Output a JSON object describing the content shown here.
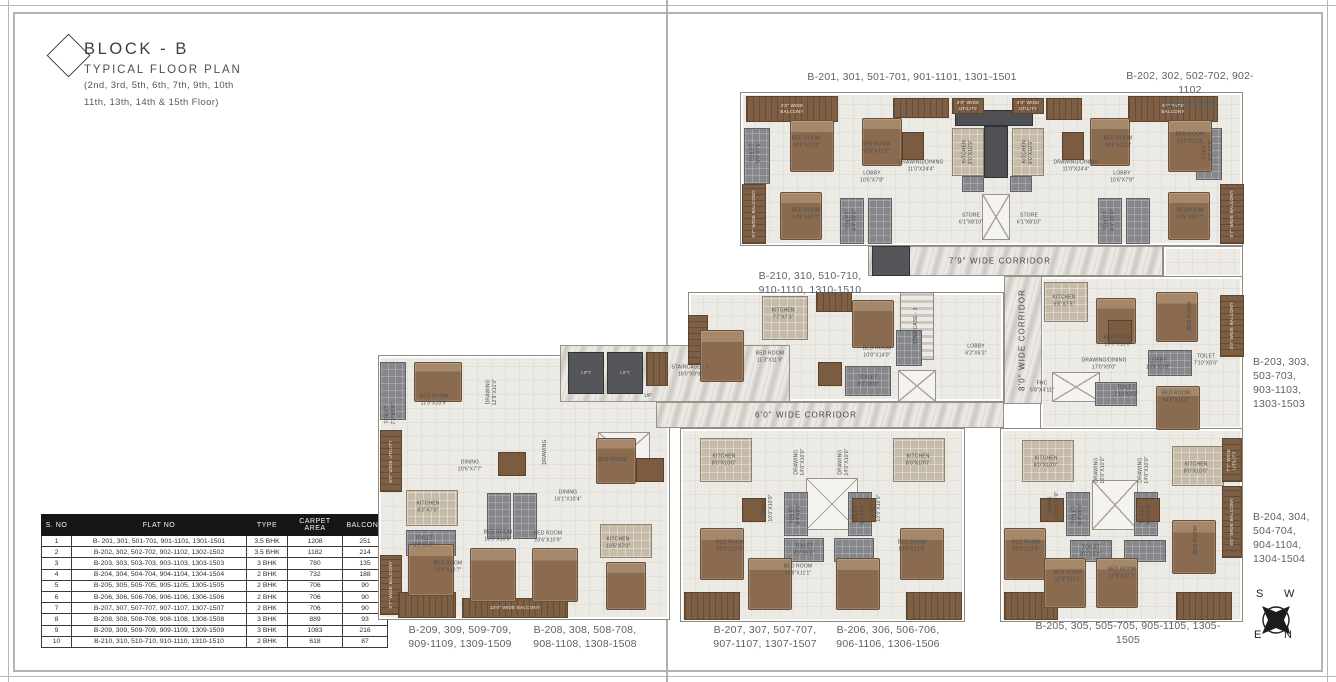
{
  "title": {
    "block": "BLOCK - B",
    "subtitle": "TYPICAL FLOOR PLAN",
    "floors1": "(2nd, 3rd, 5th, 6th, 7th, 9th, 10th",
    "floors2": "11th, 13th, 14th & 15th Floor)"
  },
  "table": {
    "headers": [
      "S. NO",
      "FLAT NO",
      "TYPE",
      "CARPET AREA",
      "BALCONY"
    ],
    "rows": [
      [
        "1",
        "B- 201, 301, 501-701, 901-1101, 1301-1501",
        "3.5 BHK",
        "1208",
        "251"
      ],
      [
        "2",
        "B-202, 302, 502-702, 902-1102, 1302-1502",
        "3.5 BHK",
        "1182",
        "214"
      ],
      [
        "3",
        "B-203, 303, 503-703, 903-1103, 1303-1503",
        "3 BHK",
        "780",
        "135"
      ],
      [
        "4",
        "B-204, 304, 504-704, 904-1104, 1304-1504",
        "2 BHK",
        "732",
        "188"
      ],
      [
        "5",
        "B-205, 305, 505-705, 905-1105, 1305-1505",
        "2 BHK",
        "706",
        "90"
      ],
      [
        "6",
        "B-206, 306, 506-706, 906-1106, 1306-1506",
        "2 BHK",
        "706",
        "90"
      ],
      [
        "7",
        "B-207, 307, 507-707, 907-1107, 1307-1507",
        "2 BHK",
        "706",
        "90"
      ],
      [
        "8",
        "B-208, 308, 508-708, 908-1108, 1308-1508",
        "3 BHK",
        "889",
        "93"
      ],
      [
        "9",
        "B-209, 309, 509-709, 909-1109, 1309-1509",
        "3 BHK",
        "1083",
        "216"
      ],
      [
        "10",
        "B-210, 310, 510-710, 910-1110, 1310-1510",
        "2 BHK",
        "618",
        "87"
      ]
    ]
  },
  "compass": {
    "letters": [
      "S",
      "W",
      "E",
      "N"
    ]
  },
  "colors": {
    "ink": "#3c4043",
    "label_gray": "#5d6167",
    "table_header_bg": "#161616",
    "balcony_wood": "#7d5f45",
    "corridor_marble": "#dedad4",
    "unit_floor": "#eceae5",
    "toilet_tile": "#85878a",
    "kitchen_tile": "#c6bba8",
    "bed_wood": "#8a6b50"
  },
  "plan": {
    "shapes": [
      [
        "u",
        740,
        92,
        503,
        154
      ],
      [
        "u",
        1163,
        246,
        80,
        32
      ],
      [
        "u",
        688,
        292,
        316,
        110
      ],
      [
        "u",
        1040,
        276,
        203,
        154
      ],
      [
        "u",
        378,
        355,
        292,
        265
      ],
      [
        "u",
        680,
        428,
        285,
        194
      ],
      [
        "u",
        1000,
        428,
        243,
        194
      ],
      [
        "c",
        868,
        246,
        295,
        30
      ],
      [
        "c",
        1004,
        276,
        38,
        128
      ],
      [
        "c",
        656,
        402,
        348,
        26
      ],
      [
        "c",
        560,
        345,
        230,
        57
      ],
      [
        "co",
        955,
        110,
        78,
        16
      ],
      [
        "co",
        984,
        126,
        24,
        52
      ],
      [
        "t",
        962,
        176,
        22,
        16
      ],
      [
        "t",
        1010,
        176,
        22,
        16
      ],
      [
        "x",
        982,
        194,
        28,
        46
      ],
      [
        "x",
        898,
        370,
        38,
        32
      ],
      [
        "x",
        1052,
        372,
        48,
        30
      ],
      [
        "x",
        598,
        432,
        52,
        46
      ],
      [
        "x",
        806,
        478,
        52,
        52
      ],
      [
        "x",
        1092,
        480,
        46,
        50
      ],
      [
        "l",
        568,
        352,
        36,
        42,
        "LIFT"
      ],
      [
        "l",
        607,
        352,
        36,
        42,
        "LIFT"
      ],
      [
        "l",
        872,
        246,
        38,
        30
      ],
      [
        "s",
        900,
        292,
        34,
        68
      ],
      [
        "k",
        952,
        128,
        32,
        48
      ],
      [
        "k",
        1012,
        128,
        32,
        48
      ],
      [
        "k",
        762,
        296,
        46,
        44
      ],
      [
        "k",
        1044,
        282,
        44,
        40
      ],
      [
        "k",
        406,
        490,
        52,
        36
      ],
      [
        "k",
        600,
        524,
        52,
        34
      ],
      [
        "k",
        700,
        438,
        52,
        44
      ],
      [
        "k",
        893,
        438,
        52,
        44
      ],
      [
        "k",
        1022,
        440,
        52,
        42
      ],
      [
        "k",
        1172,
        446,
        52,
        40
      ],
      [
        "t",
        744,
        128,
        26,
        56
      ],
      [
        "t",
        840,
        198,
        24,
        46
      ],
      [
        "t",
        868,
        198,
        24,
        46
      ],
      [
        "t",
        1196,
        128,
        26,
        52
      ],
      [
        "t",
        1098,
        198,
        24,
        46
      ],
      [
        "t",
        1126,
        198,
        24,
        46
      ],
      [
        "t",
        845,
        366,
        46,
        30
      ],
      [
        "t",
        896,
        330,
        26,
        36
      ],
      [
        "t",
        1148,
        350,
        44,
        26
      ],
      [
        "t",
        1095,
        382,
        42,
        24
      ],
      [
        "t",
        380,
        362,
        26,
        58
      ],
      [
        "t",
        406,
        530,
        50,
        26
      ],
      [
        "t",
        487,
        493,
        24,
        46
      ],
      [
        "t",
        513,
        493,
        24,
        46
      ],
      [
        "t",
        784,
        492,
        24,
        44
      ],
      [
        "t",
        848,
        492,
        24,
        44
      ],
      [
        "t",
        784,
        538,
        40,
        24
      ],
      [
        "t",
        834,
        538,
        40,
        24
      ],
      [
        "t",
        1066,
        492,
        24,
        44
      ],
      [
        "t",
        1134,
        492,
        24,
        44
      ],
      [
        "t",
        1070,
        540,
        42,
        22
      ],
      [
        "t",
        1124,
        540,
        42,
        22
      ],
      [
        "b",
        746,
        96,
        92,
        26,
        "4'0\" WIDE\nBALCONY"
      ],
      [
        "b",
        893,
        98,
        56,
        20
      ],
      [
        "b",
        952,
        98,
        32,
        16,
        "4'0\" WIDE\nUTILITY"
      ],
      [
        "b",
        1012,
        98,
        32,
        16,
        "4'0\" WIDE\nUTILITY"
      ],
      [
        "b",
        1046,
        98,
        36,
        22
      ],
      [
        "b",
        1128,
        96,
        90,
        26,
        "4'0\" WIDE\nBALCONY"
      ],
      [
        "b",
        742,
        184,
        24,
        60,
        "5'7\" WIDE BALCONY",
        1
      ],
      [
        "b",
        1220,
        184,
        24,
        60,
        "5'7\" WIDE BALCONY",
        1
      ],
      [
        "b",
        816,
        292,
        36,
        20
      ],
      [
        "b",
        688,
        315,
        20,
        50,
        null,
        1
      ],
      [
        "b",
        1220,
        295,
        24,
        62,
        "4'0\" WIDE BALCONY",
        1
      ],
      [
        "b",
        1222,
        438,
        20,
        44,
        "7'7\" WIDE\nUTILITY",
        1
      ],
      [
        "b",
        1222,
        486,
        20,
        72,
        "5'5\" WIDE BALCONY",
        1
      ],
      [
        "b",
        380,
        430,
        22,
        62,
        "5'0\" WIDE UTILITY",
        1
      ],
      [
        "b",
        380,
        555,
        22,
        60,
        "5'7\" WIDE BALCONY",
        1
      ],
      [
        "b",
        398,
        592,
        58,
        26
      ],
      [
        "b",
        462,
        598,
        106,
        20,
        "10'0\" WIDE BALCONY"
      ],
      [
        "b",
        646,
        352,
        22,
        34
      ],
      [
        "b",
        684,
        592,
        56,
        28
      ],
      [
        "b",
        906,
        592,
        56,
        28
      ],
      [
        "b",
        1004,
        592,
        54,
        28
      ],
      [
        "b",
        1176,
        592,
        56,
        28
      ],
      [
        "bd",
        790,
        120,
        44,
        52
      ],
      [
        "bd",
        862,
        118,
        40,
        48
      ],
      [
        "bd",
        780,
        192,
        42,
        48
      ],
      [
        "bd",
        1090,
        118,
        40,
        48
      ],
      [
        "bd",
        1168,
        120,
        44,
        52
      ],
      [
        "bd",
        1168,
        192,
        42,
        48
      ],
      [
        "bd",
        700,
        330,
        44,
        52
      ],
      [
        "bd",
        852,
        300,
        42,
        48
      ],
      [
        "bd",
        1096,
        298,
        40,
        46
      ],
      [
        "bd",
        1156,
        292,
        42,
        50
      ],
      [
        "bd",
        1156,
        386,
        44,
        44
      ],
      [
        "bd",
        414,
        362,
        48,
        40
      ],
      [
        "bd",
        408,
        544,
        46,
        52
      ],
      [
        "bd",
        470,
        548,
        46,
        54
      ],
      [
        "bd",
        532,
        548,
        46,
        54
      ],
      [
        "bd",
        596,
        438,
        40,
        46
      ],
      [
        "bd",
        606,
        562,
        40,
        48
      ],
      [
        "bd",
        700,
        528,
        44,
        52
      ],
      [
        "bd",
        748,
        558,
        44,
        52
      ],
      [
        "bd",
        836,
        558,
        44,
        52
      ],
      [
        "bd",
        900,
        528,
        44,
        52
      ],
      [
        "bd",
        1004,
        528,
        42,
        52
      ],
      [
        "bd",
        1044,
        558,
        42,
        50
      ],
      [
        "bd",
        1096,
        558,
        42,
        50
      ],
      [
        "bd",
        1172,
        520,
        44,
        54
      ],
      [
        "dt",
        902,
        132,
        22,
        28
      ],
      [
        "dt",
        1062,
        132,
        22,
        28
      ],
      [
        "dt",
        818,
        362,
        24,
        24
      ],
      [
        "dt",
        498,
        452,
        28,
        24
      ],
      [
        "dt",
        636,
        458,
        28,
        24
      ],
      [
        "dt",
        742,
        498,
        24,
        24
      ],
      [
        "dt",
        852,
        498,
        24,
        24
      ],
      [
        "dt",
        1040,
        498,
        24,
        24
      ],
      [
        "dt",
        1136,
        498,
        24,
        24
      ],
      [
        "dt",
        1108,
        320,
        24,
        24
      ]
    ],
    "labels": [
      [
        "corr",
        1000,
        261,
        "7'9\" WIDE CORRIDOR"
      ],
      [
        "corr",
        1022,
        340,
        "8'0\" WIDE CORRIDOR",
        1
      ],
      [
        "corr",
        806,
        415,
        "6'0\" WIDE CORRIDOR"
      ],
      [
        "unit",
        912,
        77,
        "B-201, 301, 501-701, 901-1101, 1301-1501"
      ],
      [
        "unit",
        1190,
        90,
        "B-202, 302, 502-702, 902-1102\n1302-1502"
      ],
      [
        "unit",
        810,
        283,
        "B-210, 310, 510-710,\n910-1110, 1310-1510"
      ],
      [
        "unit",
        1253,
        383,
        "B-203, 303,\n503-703,\n903-1103,\n1303-1503",
        0,
        "left"
      ],
      [
        "unit",
        1253,
        538,
        "B-204, 304,\n504-704,\n904-1104,\n1304-1504",
        0,
        "left"
      ],
      [
        "unit",
        460,
        637,
        "B-209, 309, 509-709,\n909-1109, 1309-1509"
      ],
      [
        "unit",
        585,
        637,
        "B-208, 308, 508-708,\n908-1108, 1308-1508"
      ],
      [
        "unit",
        765,
        637,
        "B-207, 307, 507-707,\n907-1107, 1307-1507"
      ],
      [
        "unit",
        888,
        637,
        "B-206, 306, 506-706,\n906-1106, 1306-1506"
      ],
      [
        "unit",
        1128,
        633,
        "B-205, 305, 505-705, 905-1105, 1305-1505"
      ],
      [
        "room",
        806,
        142,
        "BED ROOM\n13'0\"X11'9\""
      ],
      [
        "room",
        876,
        148,
        "BED ROOM\n10'5\"X11'0\""
      ],
      [
        "room",
        872,
        177,
        "LOBBY\n10'5\"X7'8\""
      ],
      [
        "room",
        921,
        166,
        "DRAWING/DINING\n11'0\"X24'4\""
      ],
      [
        "room",
        968,
        152,
        "KITCHEN\n9'0\"X10'9\"",
        1
      ],
      [
        "room",
        1028,
        152,
        "KITCHEN\n9'0\"X10'9\"",
        1
      ],
      [
        "room",
        806,
        214,
        "BED ROOM\n14'5\"X10'7\""
      ],
      [
        "room",
        971,
        219,
        "STORE\n6'1\"X8'10\""
      ],
      [
        "room",
        1029,
        219,
        "STORE\n6'1\"X8'10\""
      ],
      [
        "room",
        756,
        152,
        "TOILET\n5'0\"X7'5\"",
        1
      ],
      [
        "room",
        1208,
        150,
        "TOILET\n4'5\"X7'5\"",
        1
      ],
      [
        "room",
        852,
        220,
        "TOILET\n8'4\"X5'0\"",
        1
      ],
      [
        "room",
        1110,
        220,
        "TOILET\n8'4\"X5'0\"",
        1
      ],
      [
        "room",
        1118,
        142,
        "BED ROOM\n10'5\"X11'0\""
      ],
      [
        "room",
        1190,
        138,
        "BED ROOM\n13'2\"X11'3\""
      ],
      [
        "room",
        1122,
        177,
        "LOBBY\n10'5\"X7'8\""
      ],
      [
        "room",
        1076,
        166,
        "DRAWING/DINING\n11'0\"X24'4\""
      ],
      [
        "room",
        1190,
        214,
        "BEDROOM\n14'5\"X10'7\""
      ],
      [
        "room",
        783,
        314,
        "KITCHEN\n7'7\"X7'3\""
      ],
      [
        "room",
        770,
        357,
        "BED ROOM\n11'3\"X11'9\""
      ],
      [
        "room",
        877,
        352,
        "BED ROOM\n10'0\"X14'0\""
      ],
      [
        "room",
        868,
        381,
        "TOILET\n8'2\"X5'0\""
      ],
      [
        "room",
        976,
        350,
        "LOBBY\n6'2\"X6'3\""
      ],
      [
        "room",
        916,
        326,
        "STAIRCASE - 2",
        1
      ],
      [
        "room",
        690,
        371,
        "STAIRCASE - 1\n18'0\"X9'9\""
      ],
      [
        "room",
        648,
        396,
        "UP"
      ],
      [
        "room",
        1064,
        301,
        "KITCHEN\n9'5\"X7'5\""
      ],
      [
        "room",
        1118,
        341,
        "BED ROOM\n10'0\"X10'0\""
      ],
      [
        "room",
        1104,
        364,
        "DRAWING/DINING\n17'0\"X9'0\""
      ],
      [
        "room",
        1158,
        364,
        "LOBBY\n13'4\"X3'8\""
      ],
      [
        "room",
        1206,
        360,
        "TOILET\n7'10\"X5'0\""
      ],
      [
        "room",
        1042,
        387,
        "FHC\n5'8\"X4'11\""
      ],
      [
        "room",
        1190,
        316,
        "BED ROOM",
        1
      ],
      [
        "room",
        1176,
        397,
        "BED ROOM\n14'5\"X11'6\""
      ],
      [
        "room",
        1126,
        391,
        "TOILET\n7'10\"X4'0\""
      ],
      [
        "room",
        434,
        400,
        "BED ROOM\n11'0\"X10'9\""
      ],
      [
        "room",
        391,
        414,
        "TOILET\n7'2\"X5'0\"",
        1
      ],
      [
        "room",
        492,
        392,
        "DRAWING\n12'9\"X11'0\"",
        1
      ],
      [
        "room",
        470,
        466,
        "DINING\n20'6\"X7'7\""
      ],
      [
        "room",
        428,
        507,
        "KITCHEN\n8'2\"X7'0\""
      ],
      [
        "room",
        424,
        542,
        "TOILET\n8'0\"X5'0\""
      ],
      [
        "room",
        448,
        567,
        "BED ROOM\n12'9\"X10'7\""
      ],
      [
        "room",
        498,
        536,
        "BED ROOM\n10'0\"X10'0\""
      ],
      [
        "room",
        548,
        537,
        "BED ROOM\n10'6\"X10'9\""
      ],
      [
        "room",
        618,
        543,
        "KITCHEN\n10'5\"X7'0\""
      ],
      [
        "room",
        568,
        496,
        "DINING\n16'1\"X10'4\""
      ],
      [
        "room",
        545,
        452,
        "DRAWING",
        1
      ],
      [
        "room",
        612,
        460,
        "BED ROOM"
      ],
      [
        "room",
        724,
        460,
        "KITCHEN\n8'0\"X10'0\""
      ],
      [
        "room",
        918,
        460,
        "KITCHEN\n8'0\"X10'0\""
      ],
      [
        "room",
        800,
        462,
        "DRAWING\n14'0\"X10'0\"",
        1
      ],
      [
        "room",
        844,
        462,
        "DRAWING\n14'0\"X10'0\"",
        1
      ],
      [
        "room",
        768,
        508,
        "DINING\n10'0\"X10'0\"",
        1
      ],
      [
        "room",
        876,
        508,
        "DINING\n10'0\"X10'0\"",
        1
      ],
      [
        "room",
        796,
        514,
        "TOILET\n9'4\"X5'0\"",
        1
      ],
      [
        "room",
        860,
        514,
        "TOILET\n9'4\"X5'0\"",
        1
      ],
      [
        "room",
        804,
        550,
        "TOILET\n8'0\"X5'0\""
      ],
      [
        "room",
        730,
        546,
        "BED ROOM\n10'0\"X12'9\""
      ],
      [
        "room",
        912,
        546,
        "BED ROOM\n10'0\"X12'9\""
      ],
      [
        "room",
        798,
        570,
        "BED ROOM\n12'9\"X11'1\""
      ],
      [
        "room",
        1046,
        462,
        "KITCHEN\n8'0\"X10'0\""
      ],
      [
        "room",
        1196,
        468,
        "KITCHEN\n8'0\"X10'0\""
      ],
      [
        "room",
        1100,
        470,
        "DRAWING\n16'0\"X10'0\"",
        1
      ],
      [
        "room",
        1144,
        470,
        "DRAWING\n14'0\"X10'0\"",
        1
      ],
      [
        "room",
        1054,
        505,
        "DINING\n10'0\"X10'0\"",
        1
      ],
      [
        "room",
        1078,
        514,
        "TOILET\n9'4\"X5'0\"",
        1
      ],
      [
        "room",
        1146,
        514,
        "TOILET\n9'4\"X5'0\"",
        1
      ],
      [
        "room",
        1091,
        551,
        "TOILET\n8'0\"X5'0\""
      ],
      [
        "room",
        1026,
        546,
        "BED ROOM\n10'0\"X12'9\""
      ],
      [
        "room",
        1068,
        576,
        "BED ROOM\n12'9\"X11'1\""
      ],
      [
        "room",
        1122,
        573,
        "BED ROOM\n12'9\"X11'7\""
      ],
      [
        "room",
        1196,
        540,
        "BED ROOM",
        1
      ]
    ]
  }
}
